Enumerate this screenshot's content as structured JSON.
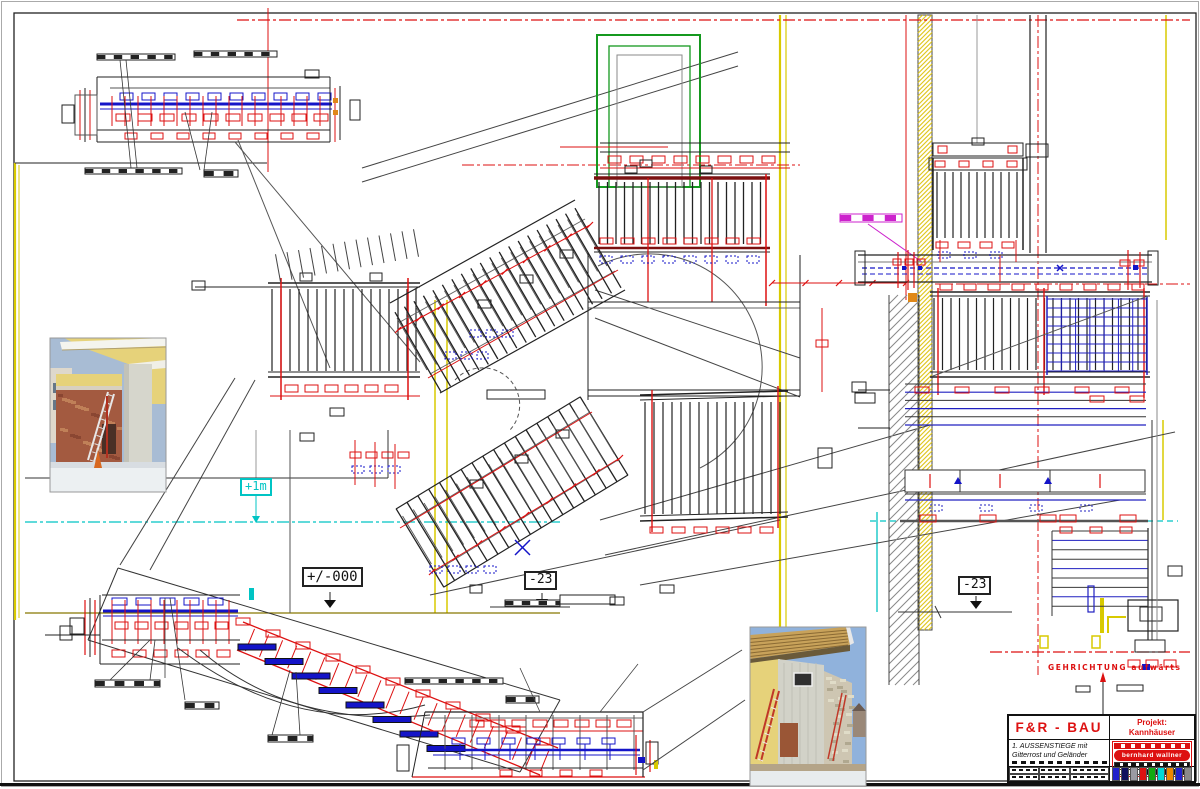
{
  "sheet": {
    "width": 1200,
    "height": 789,
    "background": "#ffffff"
  },
  "labels": {
    "level_plus1m": "+1m",
    "level_zero": "+/-000",
    "level_minus23_left": "-23",
    "level_minus23_right": "-23",
    "direction_note": "GEHRICHTUNG aufwärts"
  },
  "title_block": {
    "company": "F&R - BAU",
    "project_label": "Projekt:",
    "project_name": "Kannhäuser",
    "drawing_title_line1": "1. AUSSENSTIEGE mit",
    "drawing_title_line2": "Gitterrost und Geländer",
    "logo_text": "bernhard wallner",
    "palette": [
      "#2222cc",
      "#10105e",
      "#9a9aa2",
      "#dd1111",
      "#11aa11",
      "#00d8d8",
      "#ee8800",
      "#2222cc",
      "#8a8a8a"
    ]
  },
  "colors": {
    "line": "#222222",
    "dim_red": "#dd1111",
    "steel_blue": "#1414c8",
    "datum_cyan": "#00c4c4",
    "axis_yellow": "#d8ca00",
    "wall_hatch_yellow": "#e0c820",
    "magenta": "#cc22cc",
    "door_green": "#15991f",
    "rail_dark_red": "#7a1010",
    "ground_olive": "#887700",
    "orange": "#e08818"
  },
  "photos": [
    {
      "name": "site-photo-1",
      "description": "brick wall with ladder at construction site"
    },
    {
      "name": "site-photo-2",
      "description": "concrete wall and timber roof overhang"
    }
  ]
}
